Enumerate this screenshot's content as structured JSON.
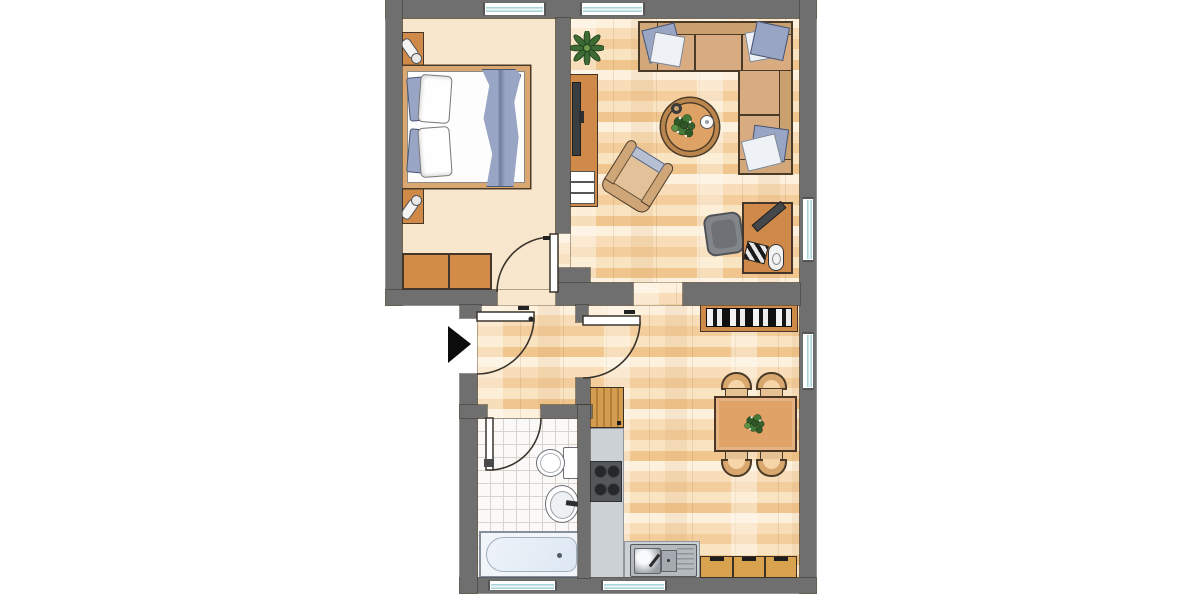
{
  "scene": {
    "type": "apartment-floor-plan",
    "rooms": [
      "bedroom",
      "living-room",
      "hallway",
      "bathroom",
      "kitchen",
      "dining-area"
    ],
    "doors": [
      "entrance-door",
      "bedroom-door",
      "bathroom-door",
      "living-area-door"
    ],
    "windows": {
      "top": 2,
      "right": 2,
      "bottom": 2
    },
    "furniture": [
      "double-bed",
      "nightstand",
      "nightstand",
      "dresser",
      "tv-sideboard",
      "potted-plant",
      "corner-sofa",
      "coffee-table",
      "armchair",
      "desk",
      "office-chair",
      "bookshelf",
      "dining-table",
      "dining-chair",
      "dining-chair",
      "dining-chair",
      "dining-chair",
      "kitchen-cabinet",
      "stove",
      "kitchen-sink",
      "base-cabinets",
      "bathtub",
      "toilet",
      "wash-basin"
    ]
  },
  "palette": {
    "outside": "#ffffff",
    "wall": "#6f6f6f",
    "bedroomFloor": "#f9e7cd",
    "parquet": "#f6d5a8",
    "tile": "#faf9f7",
    "tileLine": "#d8d4cd",
    "wood": "#cf8a4a",
    "woodLight": "#d9a24f",
    "bedFrame": "#d9a76f",
    "textile": "#98a5c4",
    "pillowWhite": "#eef1f6",
    "sofa": "#d9ab80",
    "sofaBack": "#caa06f",
    "counter": "#ccd1d5",
    "steel": "#b5babf",
    "stove": "#55585b",
    "tub": "#dde7f2",
    "glass": "#a9d3da",
    "chairGray": "#82868a",
    "green": "#3c6b33",
    "ink": "#3a342c"
  }
}
